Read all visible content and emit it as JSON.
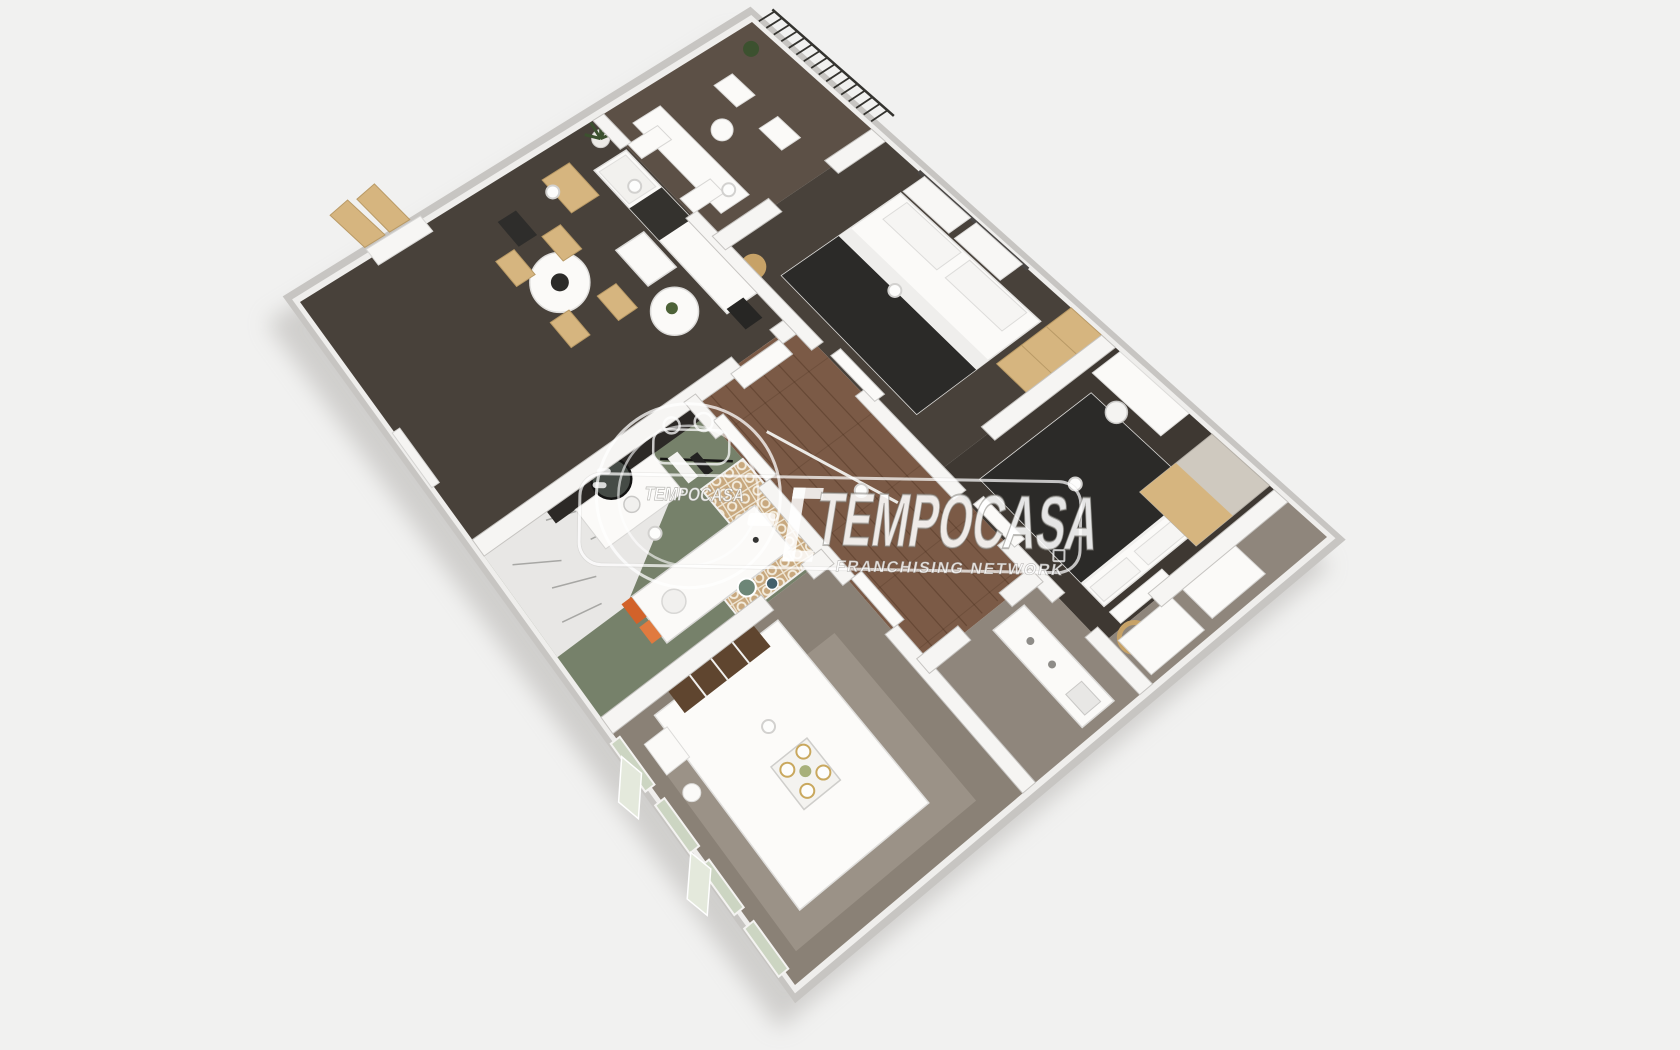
{
  "watermark": {
    "brand_large": "TEMPOCASA",
    "brand_small": "TEMPOCASA",
    "subtitle": "FRANCHISING NETWORK"
  },
  "semantics": {
    "image_type": "3d-floor-plan-render",
    "rooms": [
      "living-room",
      "balcony",
      "bedroom-1",
      "bedroom-2",
      "bathroom",
      "bedroom-3",
      "hallway",
      "kitchen",
      "entry"
    ]
  },
  "colors": {
    "background": "#f1f1f0",
    "plan_shadow": "#b5b3b0",
    "wall_outer": "#c7c5c2",
    "wall_top": "#efeeec",
    "wall_inner": "#f6f5f3",
    "floor_dark": "#48413a",
    "floor_dark2": "#3e3832",
    "floor_wood": "#7b5a46",
    "floor_gray": "#8f867c",
    "floor_taupe": "#8a8176",
    "floor_balcony": "#5c5046",
    "green_floor": "#76816a",
    "marble": "#e8e7e5",
    "tile_tan": "#c8a87e",
    "furniture_white": "#fbfaf8",
    "furniture_tan": "#d6b57f",
    "furniture_tan2": "#c7a267",
    "dark_fabric": "#2b2a28",
    "headboard_brown": "#5f452f",
    "orange_accent": "#d2622a",
    "plant_green": "#3c512f",
    "railing_dark": "#34332f",
    "watermark_white": "rgba(255,255,255,0.85)"
  }
}
